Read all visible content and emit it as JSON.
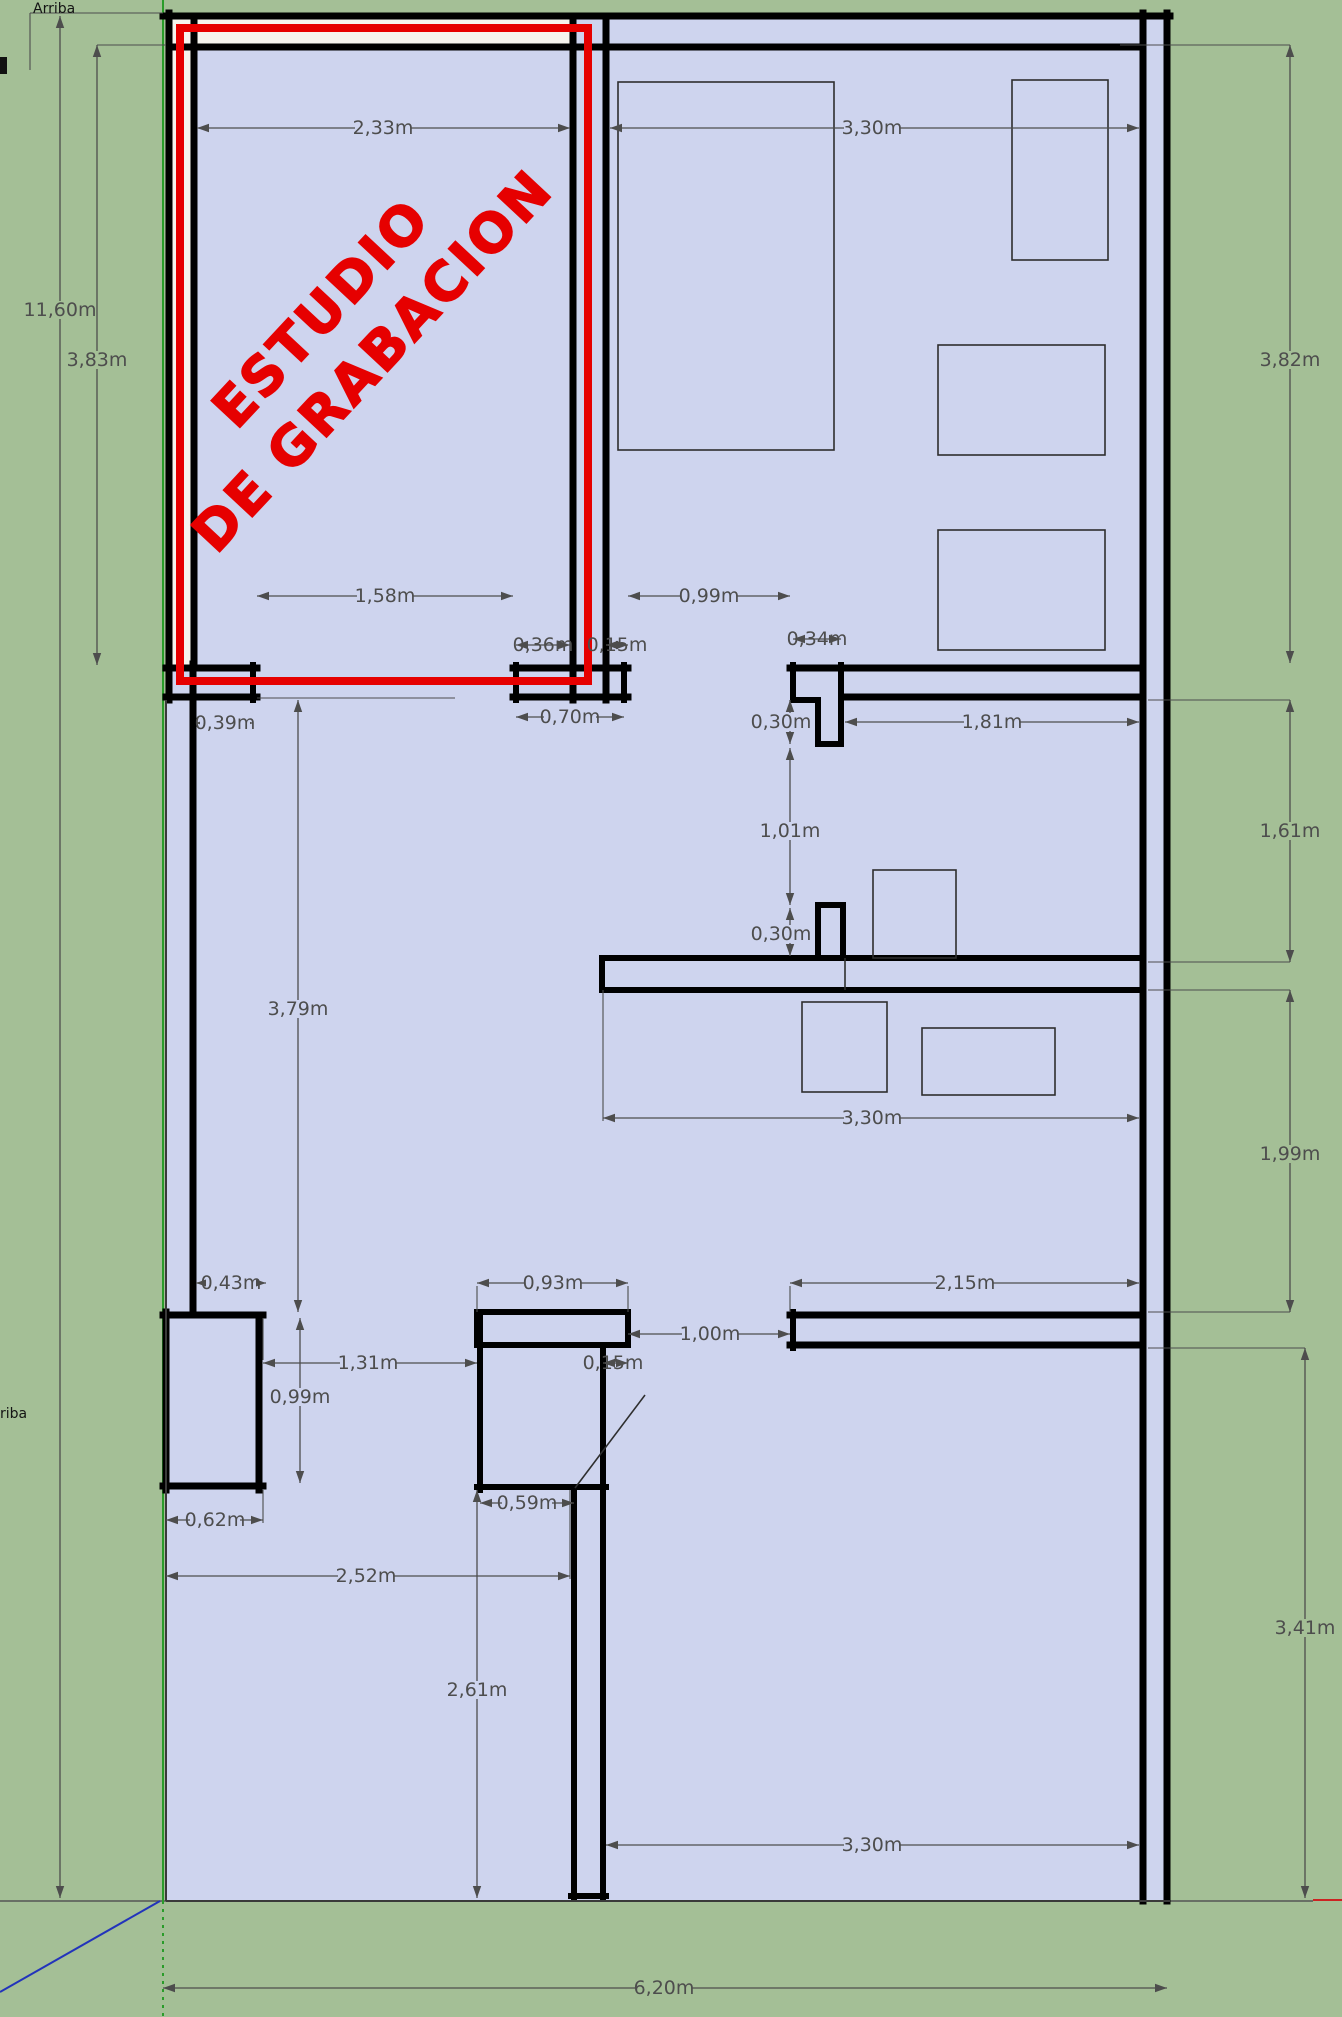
{
  "annotations": {
    "arriba_top": "Arriba",
    "arriba_left": "riba"
  },
  "highlight": {
    "line1": "ESTUDIO",
    "line2": "DE GRABACION",
    "color": "#e60000"
  },
  "colors": {
    "ground": "#a4bf96",
    "floor": "#ced4ee",
    "wall": "#000000",
    "studio_wall_fill": "#f6f4ee",
    "dimension": "#4d4d4d",
    "axis_green": "#2a9c2a",
    "axis_blue": "#2233bb",
    "axis_red": "#cc2222",
    "highlight_red": "#e60000"
  },
  "dimensions": {
    "d2_33": "2,33m",
    "d3_30_top": "3,30m",
    "d11_60": "11,60m",
    "d3_83": "3,83m",
    "d3_82": "3,82m",
    "d1_58": "1,58m",
    "d0_99_top": "0,99m",
    "d0_36": "0,36m",
    "d0_15_top": "0,15m",
    "d0_34": "0,34m",
    "d0_39": "0,39m",
    "d0_70": "0,70m",
    "d0_30_a": "0,30m",
    "d1_81": "1,81m",
    "d1_61": "1,61m",
    "d1_01": "1,01m",
    "d0_30_b": "0,30m",
    "d3_79": "3,79m",
    "d3_30_mid": "3,30m",
    "d1_99": "1,99m",
    "d0_43": "0,43m",
    "d0_93": "0,93m",
    "d2_15": "2,15m",
    "d1_00": "1,00m",
    "d1_31": "1,31m",
    "d0_15_low": "0,15m",
    "d0_99_low": "0,99m",
    "d0_62": "0,62m",
    "d0_59": "0,59m",
    "d2_52": "2,52m",
    "d2_61": "2,61m",
    "d3_41": "3,41m",
    "d3_30_bot": "3,30m",
    "d6_20": "6,20m"
  }
}
